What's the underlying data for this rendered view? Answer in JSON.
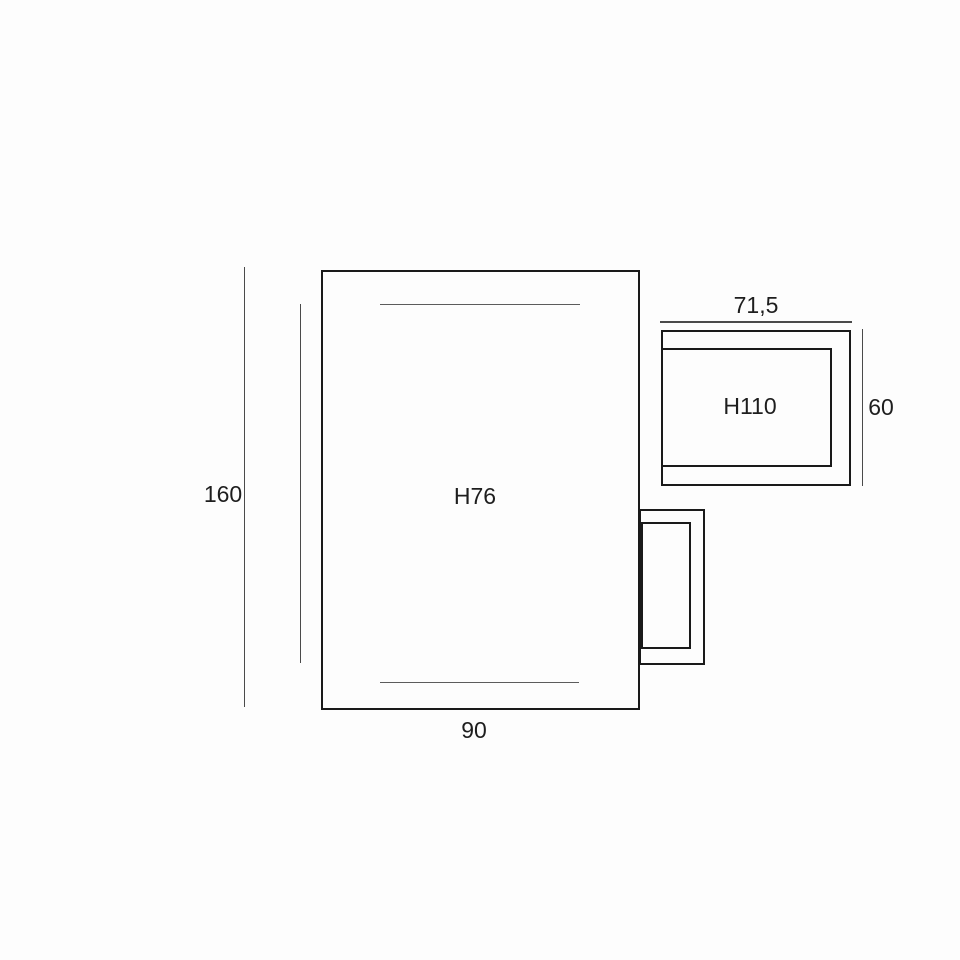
{
  "diagram": {
    "colors": {
      "background": "#fdfdfd",
      "outline": "#1a1a1a",
      "dimension_line": "#4a4a4a",
      "text": "#1e1e1e"
    },
    "base_unit": {
      "model_label": "H76",
      "width_dimension": "90",
      "height_dimension": "160"
    },
    "wall_unit": {
      "model_label": "H110",
      "width_dimension": "71,5",
      "height_dimension": "60"
    }
  }
}
